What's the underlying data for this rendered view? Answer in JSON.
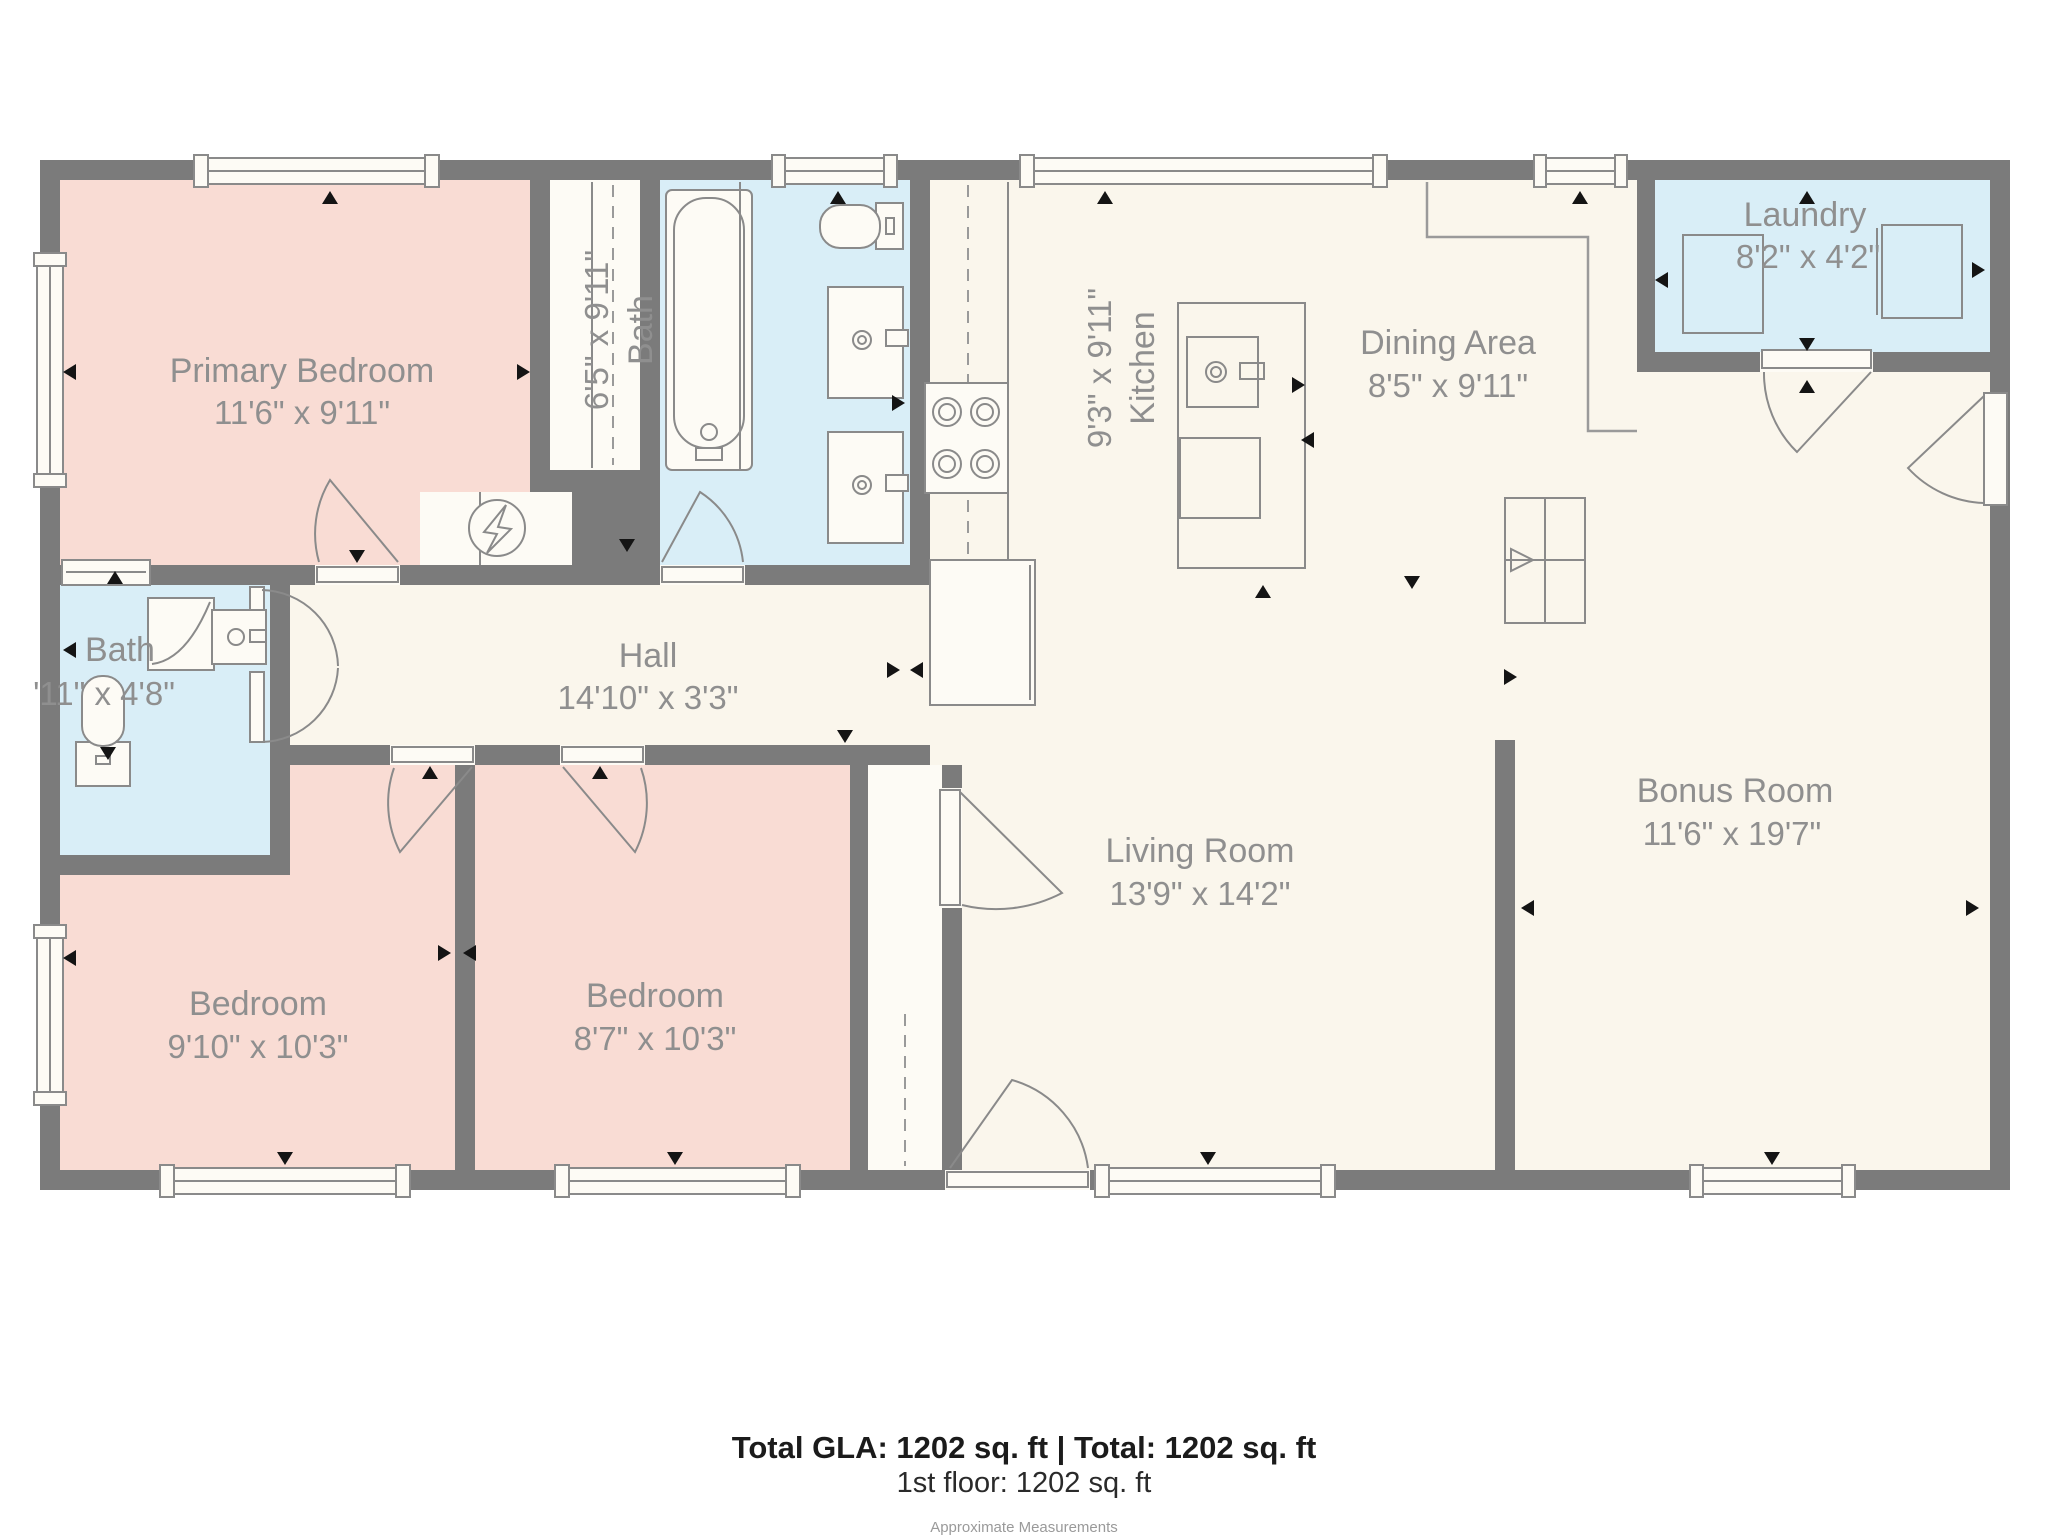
{
  "meta": {
    "type": "floor-plan",
    "colors": {
      "wall": "#7b7b7b",
      "floor": "#faf6ec",
      "bedroom_fill": "#f9dcd4",
      "wet_room_fill": "#d9eef7",
      "fixture_line": "#8a8a8a",
      "label_text": "#8f8f8f",
      "footer_text": "#1b1b1b"
    }
  },
  "rooms": {
    "primary_bedroom": {
      "name": "Primary Bedroom",
      "dims": "11'6\" x 9'11\""
    },
    "bath_top": {
      "name": "Bath",
      "dims": "6'5\" x 9'11\""
    },
    "kitchen": {
      "name": "Kitchen",
      "dims": "9'3\" x 9'11\""
    },
    "dining": {
      "name": "Dining Area",
      "dims": "8'5\" x 9'11\""
    },
    "laundry": {
      "name": "Laundry",
      "dims": "8'2\" x 4'2\""
    },
    "bath_left": {
      "name": "Bath",
      "dims": "'11\" x 4'8\""
    },
    "hall": {
      "name": "Hall",
      "dims": "14'10\" x 3'3\""
    },
    "bedroom_left": {
      "name": "Bedroom",
      "dims": "9'10\" x 10'3\""
    },
    "bedroom_mid": {
      "name": "Bedroom",
      "dims": "8'7\" x 10'3\""
    },
    "living": {
      "name": "Living Room",
      "dims": "13'9\" x 14'2\""
    },
    "bonus": {
      "name": "Bonus Room",
      "dims": "11'6\" x 19'7\""
    }
  },
  "footer": {
    "totals": "Total GLA: 1202 sq. ft | Total: 1202 sq. ft",
    "floor_line": "1st floor: 1202 sq. ft",
    "disclaimer": "Approximate Measurements"
  }
}
